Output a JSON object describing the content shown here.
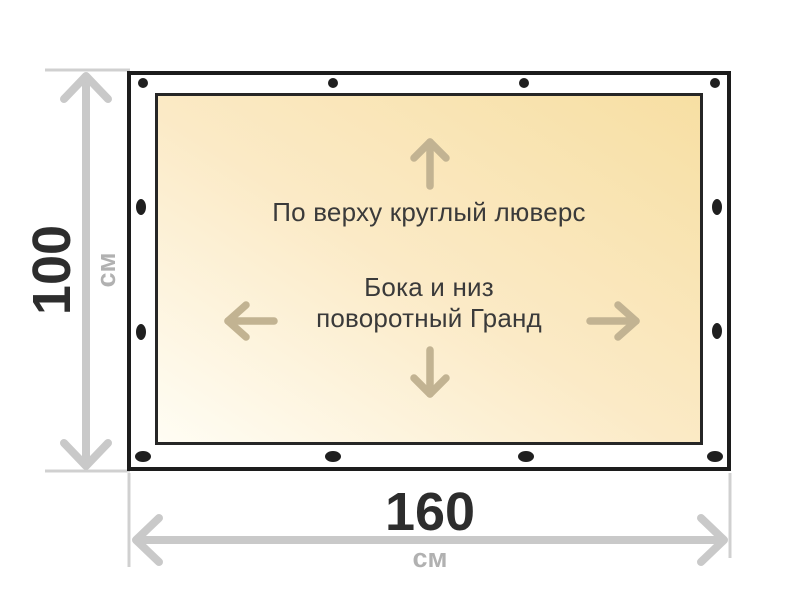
{
  "banner": {
    "note_top": "По верху круглый люверс",
    "note_sides_line1": "Бока и низ",
    "note_sides_line2": "поворотный Гранд"
  },
  "dimensions": {
    "height": {
      "value": "100",
      "unit": "см"
    },
    "width": {
      "value": "160",
      "unit": "см"
    }
  },
  "grommets": {
    "top_count": 4,
    "bottom_count": 4,
    "left_count": 2,
    "right_count": 2
  },
  "icons": [
    "arrow-up-icon",
    "arrow-down-icon",
    "arrow-left-icon",
    "arrow-right-icon"
  ],
  "colors": {
    "banner_fill_light": "#fffdf4",
    "banner_fill_dark": "#f7dfa3",
    "outline": "#1c1c1c",
    "grommet": "#1f1f1f",
    "dimension_line": "#c9c9c9",
    "extension_line": "#d0d0d0",
    "dimension_value": "#2d2d2d",
    "dimension_unit": "#b1b1b1",
    "direction_arrow": "#c2b392",
    "note_text": "#3a3a3a"
  }
}
